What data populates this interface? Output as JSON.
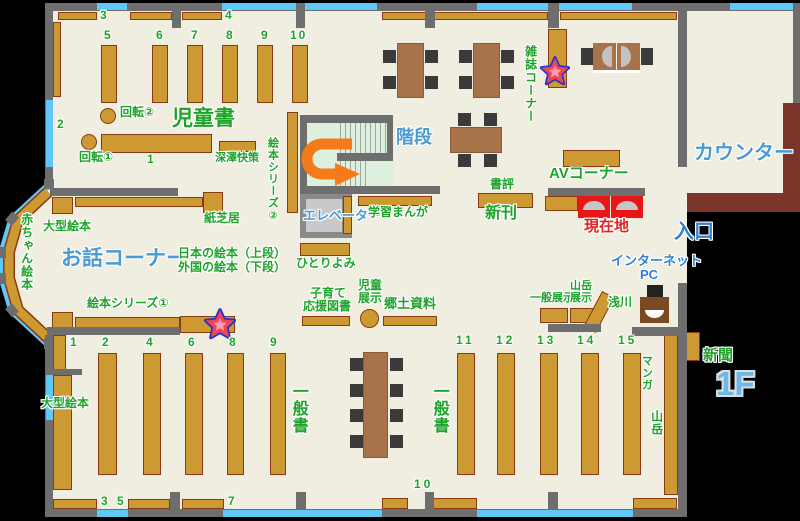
{
  "floor_label": "1F",
  "areas": {
    "children_books": "児童書",
    "story_corner": "お話コーナー",
    "stairs": "階段",
    "elevator": "エレベーター",
    "counter": "カウンター",
    "magazine_corner": "雑誌コーナー",
    "av_corner": "AVコーナー",
    "entrance": "入口",
    "internet": "インターネット",
    "pc": "PC",
    "current_location": "現在地",
    "new_books": "新刊",
    "book_review": "書評",
    "newspaper": "新聞",
    "general_books": "一般書"
  },
  "labels": {
    "rotate1": "回転①",
    "rotate2": "回転②",
    "fukasawa_kaisaku": "深澤快策",
    "picture_book_series_1": "絵本シリーズ①",
    "picture_book_series_2": "絵本シリーズ②",
    "kamishibai": "紙芝居",
    "large_picture_books": "大型絵本",
    "baby_picture_books": "赤ちゃん絵本",
    "japanese_picture_books": "日本の絵本（上段）",
    "foreign_picture_books": "外国の絵本（下段）",
    "hitoriyomi": "ひとりよみ",
    "study_manga": "学習まんが",
    "parenting_line1": "子育て",
    "parenting_line2": "応援図書",
    "children_exhibit_line1": "児童",
    "children_exhibit_line2": "展示",
    "local_materials": "郷土資料",
    "general_exhibit": "一般展示",
    "mountain_exhibit_line1": "山岳",
    "mountain_exhibit_line2": "展示",
    "asakawa": "浅川",
    "manga": "マンガ",
    "mountain": "山岳"
  },
  "shelf_numbers": {
    "children_top": [
      "3",
      "4"
    ],
    "children_vertical": [
      "5",
      "6",
      "7",
      "8",
      "9",
      "10"
    ],
    "children_left": "2",
    "children_main": "1",
    "general_left": [
      "1",
      "2",
      "4",
      "6",
      "8",
      "9"
    ],
    "general_bottom": [
      "3",
      "5",
      "7"
    ],
    "general_bottom_center": "10",
    "general_right": [
      "11",
      "12",
      "13",
      "14",
      "15"
    ]
  },
  "colors": {
    "shelf": "#cc9933",
    "wall": "#6e6e6e",
    "window": "#5fc8f8",
    "counter": "#7b352b",
    "current_location_seat": "#e81616",
    "green_text": "#1ea32a",
    "blue_text": "#4a9ad4",
    "red_text": "#e32222"
  }
}
